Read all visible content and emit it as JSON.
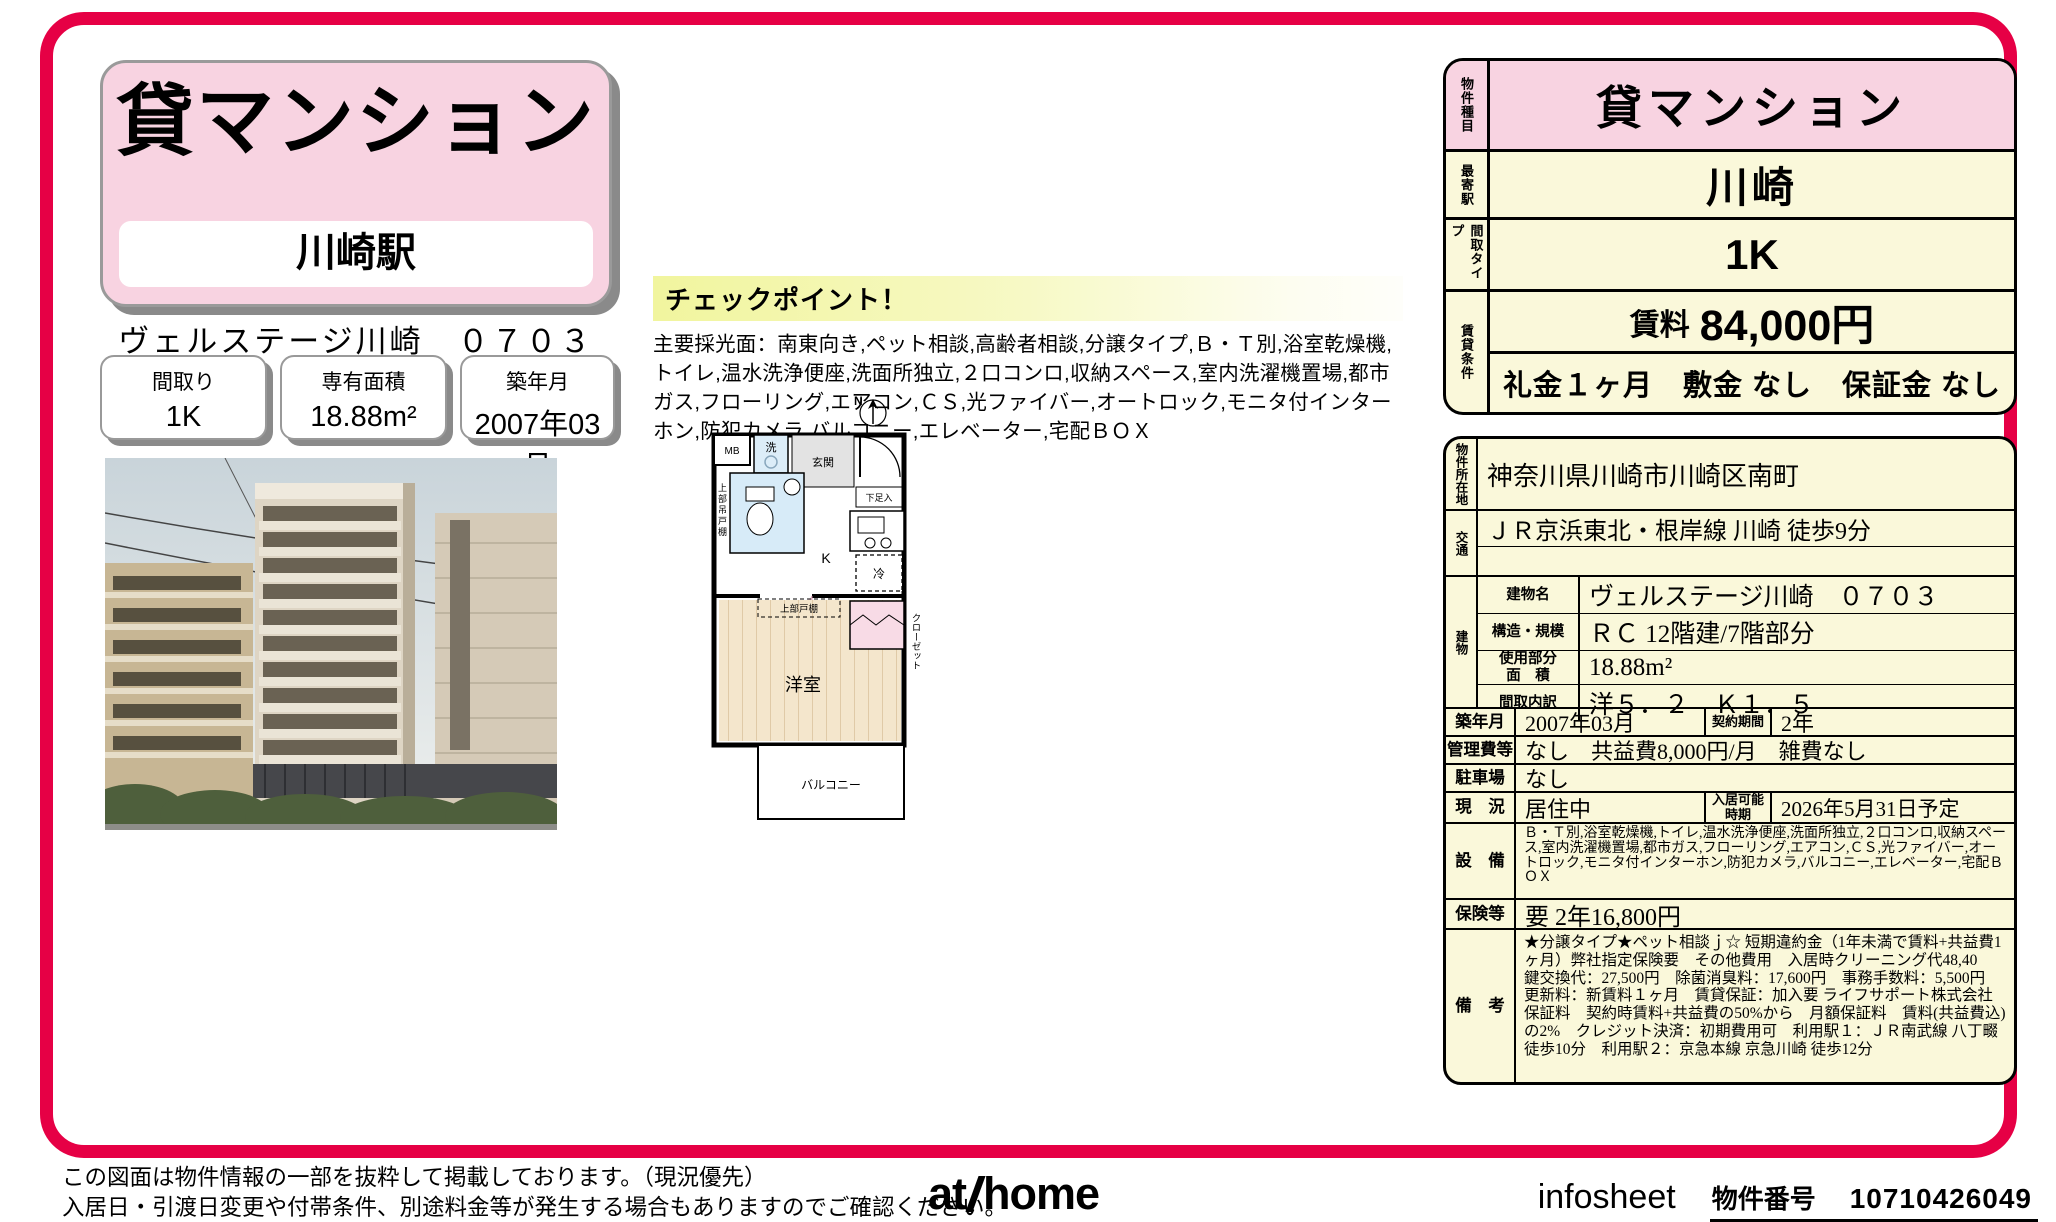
{
  "colors": {
    "frame_red": "#e60045",
    "pink": "#f8d3e1",
    "cream": "#faf8da",
    "checkpoint_yellow": "#f1f59e"
  },
  "header": {
    "property_type": "貸マンション",
    "station": "川崎駅",
    "property_name": "ヴェルステージ川崎　０７０３",
    "info_boxes": [
      {
        "label": "間取り",
        "value": "1K"
      },
      {
        "label": "専有面積",
        "value": "18.88m²"
      },
      {
        "label": "築年月",
        "value": "2007年03月"
      }
    ]
  },
  "checkpoint": {
    "title": "チェックポイント！",
    "body": "主要採光面：南東向き,ペット相談,高齢者相談,分譲タイプ,Ｂ・Ｔ別,浴室乾燥機,トイレ,温水洗浄便座,洗面所独立,２口コンロ,収納スペース,室内洗濯機置場,都市ガス,フローリング,エアコン,ＣＳ,光ファイバー,オートロック,モニタ付インターホン,防犯カメラ,バルコニー,エレベーター,宅配ＢＯＸ"
  },
  "floorplan": {
    "compass": "N",
    "mb": "MB",
    "washer": "洗",
    "entrance": "玄関",
    "shoe_box": "下足入",
    "kitchen": "K",
    "fridge": "冷",
    "upper_hanging_cabinet": "上部吊戸棚",
    "closet": "クローゼット",
    "upper_cabinet": "上部戸棚",
    "western_room": "洋室",
    "balcony": "バルコニー"
  },
  "summary_table": {
    "type_label": "物件種目",
    "type_value": "貸マンション",
    "station_label": "最寄駅",
    "station_value": "川崎",
    "layout_label": "間取タイプ",
    "layout_value": "1K",
    "terms_label": "賃貸条件",
    "rent_label": "賃料",
    "rent_value": "84,000円",
    "move_in_terms": "礼金１ヶ月　敷金 なし　保証金 なし"
  },
  "detail_table": {
    "address_label": "物件所在地",
    "address": "神奈川県川崎市川崎区南町",
    "access_label": "交通",
    "access": "ＪＲ京浜東北・根岸線 川崎 徒歩9分",
    "building_label": "建物",
    "building_name_label": "建物名",
    "building_name": "ヴェルステージ川崎　０７０３",
    "structure_label": "構造・規模",
    "structure": "ＲＣ 12階建/7階部分",
    "area_label": "使用部分\n面　積",
    "area": "18.88m²",
    "layout_detail_label": "間取内訳",
    "layout_detail": "洋５．２　Ｋ１．５",
    "built_label": "築年月",
    "built": "2007年03月",
    "contract_label": "契約期間",
    "contract": "2年",
    "fees_label": "管理費等",
    "fees": "なし　共益費8,000円/月　雑費なし",
    "parking_label": "駐車場",
    "parking": "なし",
    "status_label": "現　況",
    "status": "居住中",
    "available_label": "入居可能\n時期",
    "available": "2026年5月31日予定",
    "equipment_label": "設　備",
    "equipment": "Ｂ・Ｔ別,浴室乾燥機,トイレ,温水洗浄便座,洗面所独立,２口コンロ,収納スペース,室内洗濯機置場,都市ガス,フローリング,エアコン,ＣＳ,光ファイバー,オートロック,モニタ付インターホン,防犯カメラ,バルコニー,エレベーター,宅配ＢＯＸ",
    "insurance_label": "保険等",
    "insurance": "要 2年16,800円",
    "notes_label": "備　考",
    "notes": "★分譲タイプ★ペット相談ｊ☆ 短期違約金（1年未満で賃料+共益費1ヶ月）弊社指定保険要　その他費用　入居時クリーニング代48,40　鍵交換代：27,500円　除菌消臭料：17,600円　事務手数料：5,500円　更新料：新賃料１ヶ月　賃貸保証：加入要 ライフサポート株式会社　保証料　契約時賃料+共益費の50%から　月額保証料　賃料(共益費込)の2%　クレジット決済：初期費用可　利用駅１：ＪＲ南武線 八丁畷 徒歩10分　利用駅２：京急本線 京急川崎 徒歩12分"
  },
  "footer": {
    "disclaimer1": "この図面は物件情報の一部を抜粋して掲載しております。（現況優先）",
    "disclaimer2": "入居日・引渡日変更や付帯条件、別途料金等が発生する場合もありますのでご確認ください。",
    "logo_at": "at",
    "logo_home": "home",
    "sheet_label": "infosheet",
    "property_no_label": "物件番号",
    "property_no": "10710426049"
  }
}
